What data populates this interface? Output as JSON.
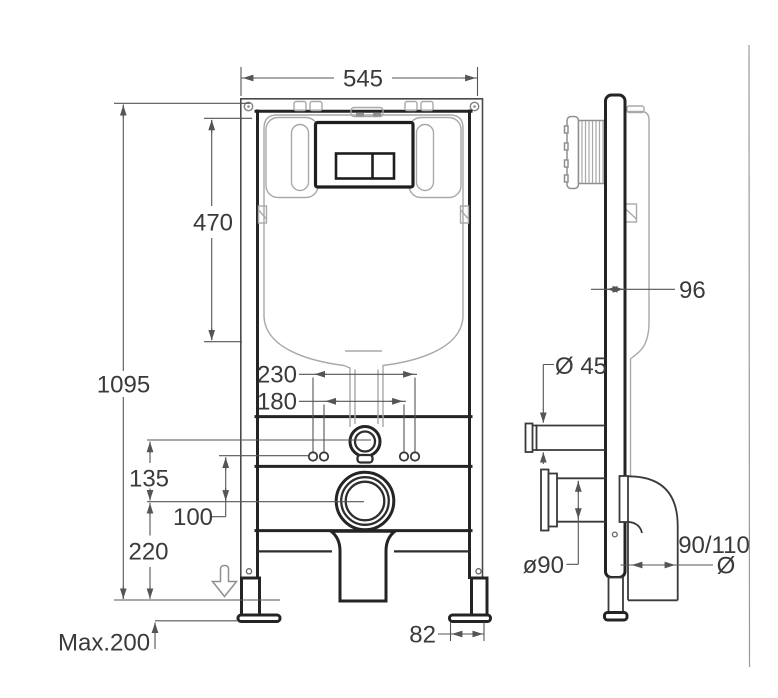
{
  "drawing": {
    "colors": {
      "background": "#ffffff",
      "frame_line": "#242424",
      "dimension_line": "#555555",
      "tank_outline": "#a9a9a9",
      "label_text": "#3a3a3a"
    },
    "front_view": {
      "dims": {
        "frame_width": "545",
        "cistern_height": "470",
        "frame_height": "1095",
        "fixing_spacing_outer": "230",
        "fixing_spacing_inner": "180",
        "flush_pipe_height": "135",
        "fixing_height": "100",
        "outlet_height": "220",
        "adjustable_feet": "Max.200",
        "foot_plate_width": "82"
      }
    },
    "side_view": {
      "dims": {
        "frame_depth": "96",
        "flush_pipe_diameter": "Ø 45",
        "outlet_diameter": "ø90",
        "waste_pipe_size": "90/110",
        "waste_pipe_diameter_symbol": "Ø"
      }
    }
  }
}
